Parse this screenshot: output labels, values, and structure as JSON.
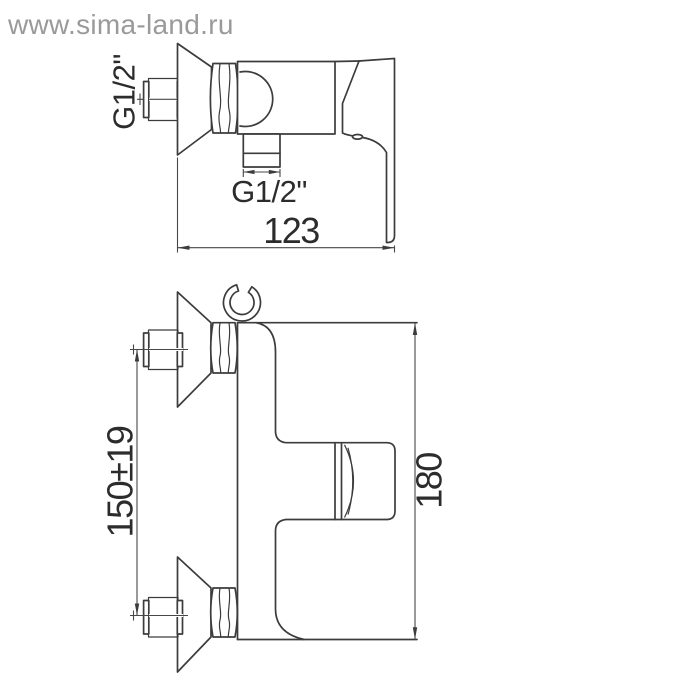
{
  "watermark": {
    "text": "www.sima-land.ru",
    "color": "#9a9a9a"
  },
  "drawing": {
    "line_color": "#3c3c3c",
    "background": "#ffffff",
    "side_view": {
      "inlet_thread_label": "G1/2\"",
      "outlet_thread_label": "G1/2\"",
      "width_dimension": "123"
    },
    "front_view": {
      "inlet_spacing_dimension": "150±19",
      "height_dimension": "180"
    }
  }
}
